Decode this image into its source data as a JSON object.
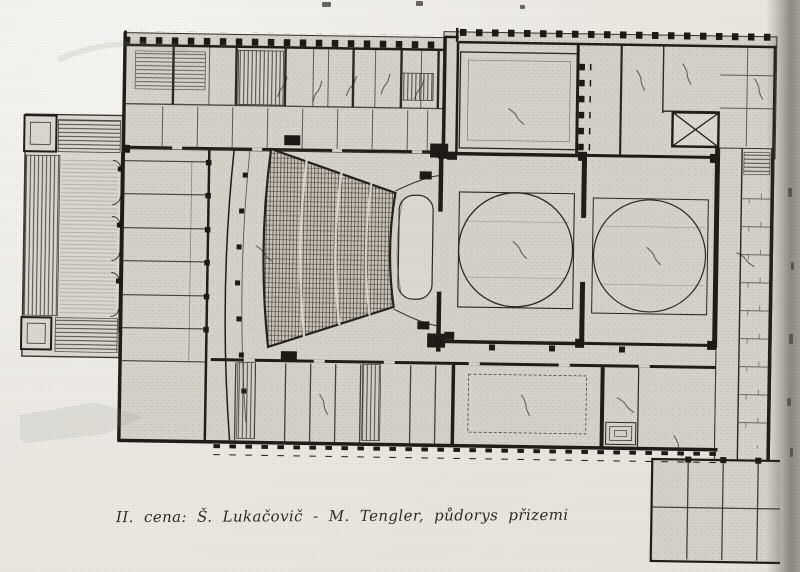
{
  "figure": {
    "caption": "II. cena: Š. Lukačovič - M. Tengler, půdorys přizemi"
  },
  "palette": {
    "paper": "#ebe8e2",
    "plan_paper": "#d7d3cb",
    "ink": "#201d19",
    "hatch_ink": "#39342d",
    "seating_ink": "#352f28",
    "edge_shadow": "#5f5a51"
  }
}
